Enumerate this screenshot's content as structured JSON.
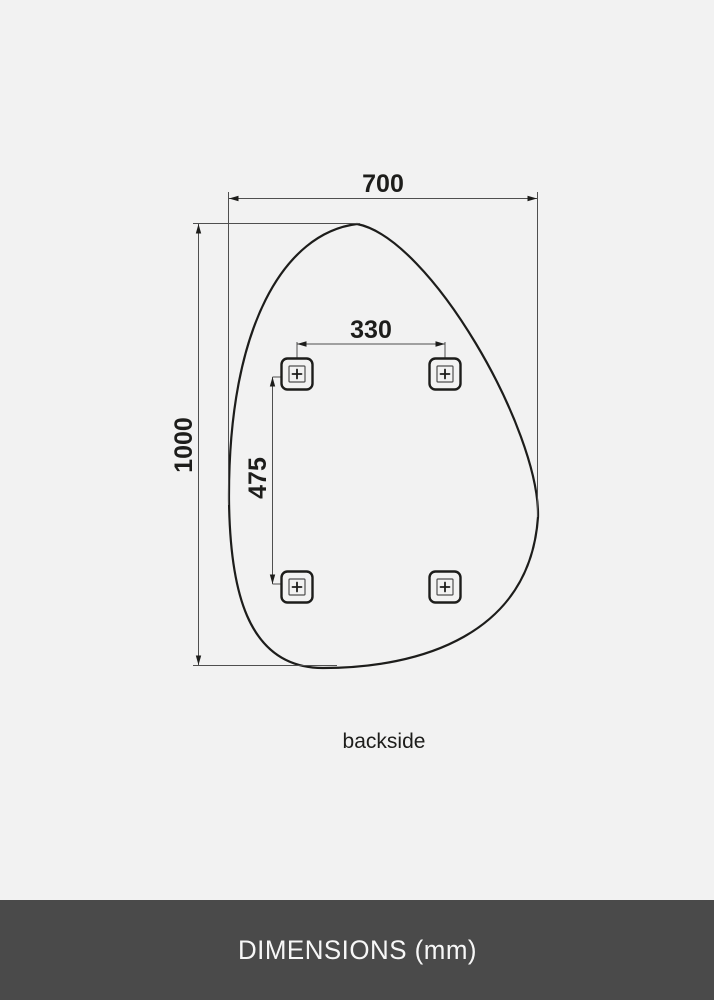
{
  "colors": {
    "background": "#f2f2f2",
    "outline": "#1d1d1b",
    "dimension_line": "#4f4f4f",
    "footer_background": "#4a4a4a",
    "footer_text": "#f7f7f7"
  },
  "diagram": {
    "overall_width_label": "700",
    "overall_height_label": "1000",
    "bracket_spacing_horizontal_label": "330",
    "bracket_spacing_vertical_label": "475",
    "view_label": "backside"
  },
  "footer": {
    "title": "DIMENSIONS (mm)"
  }
}
